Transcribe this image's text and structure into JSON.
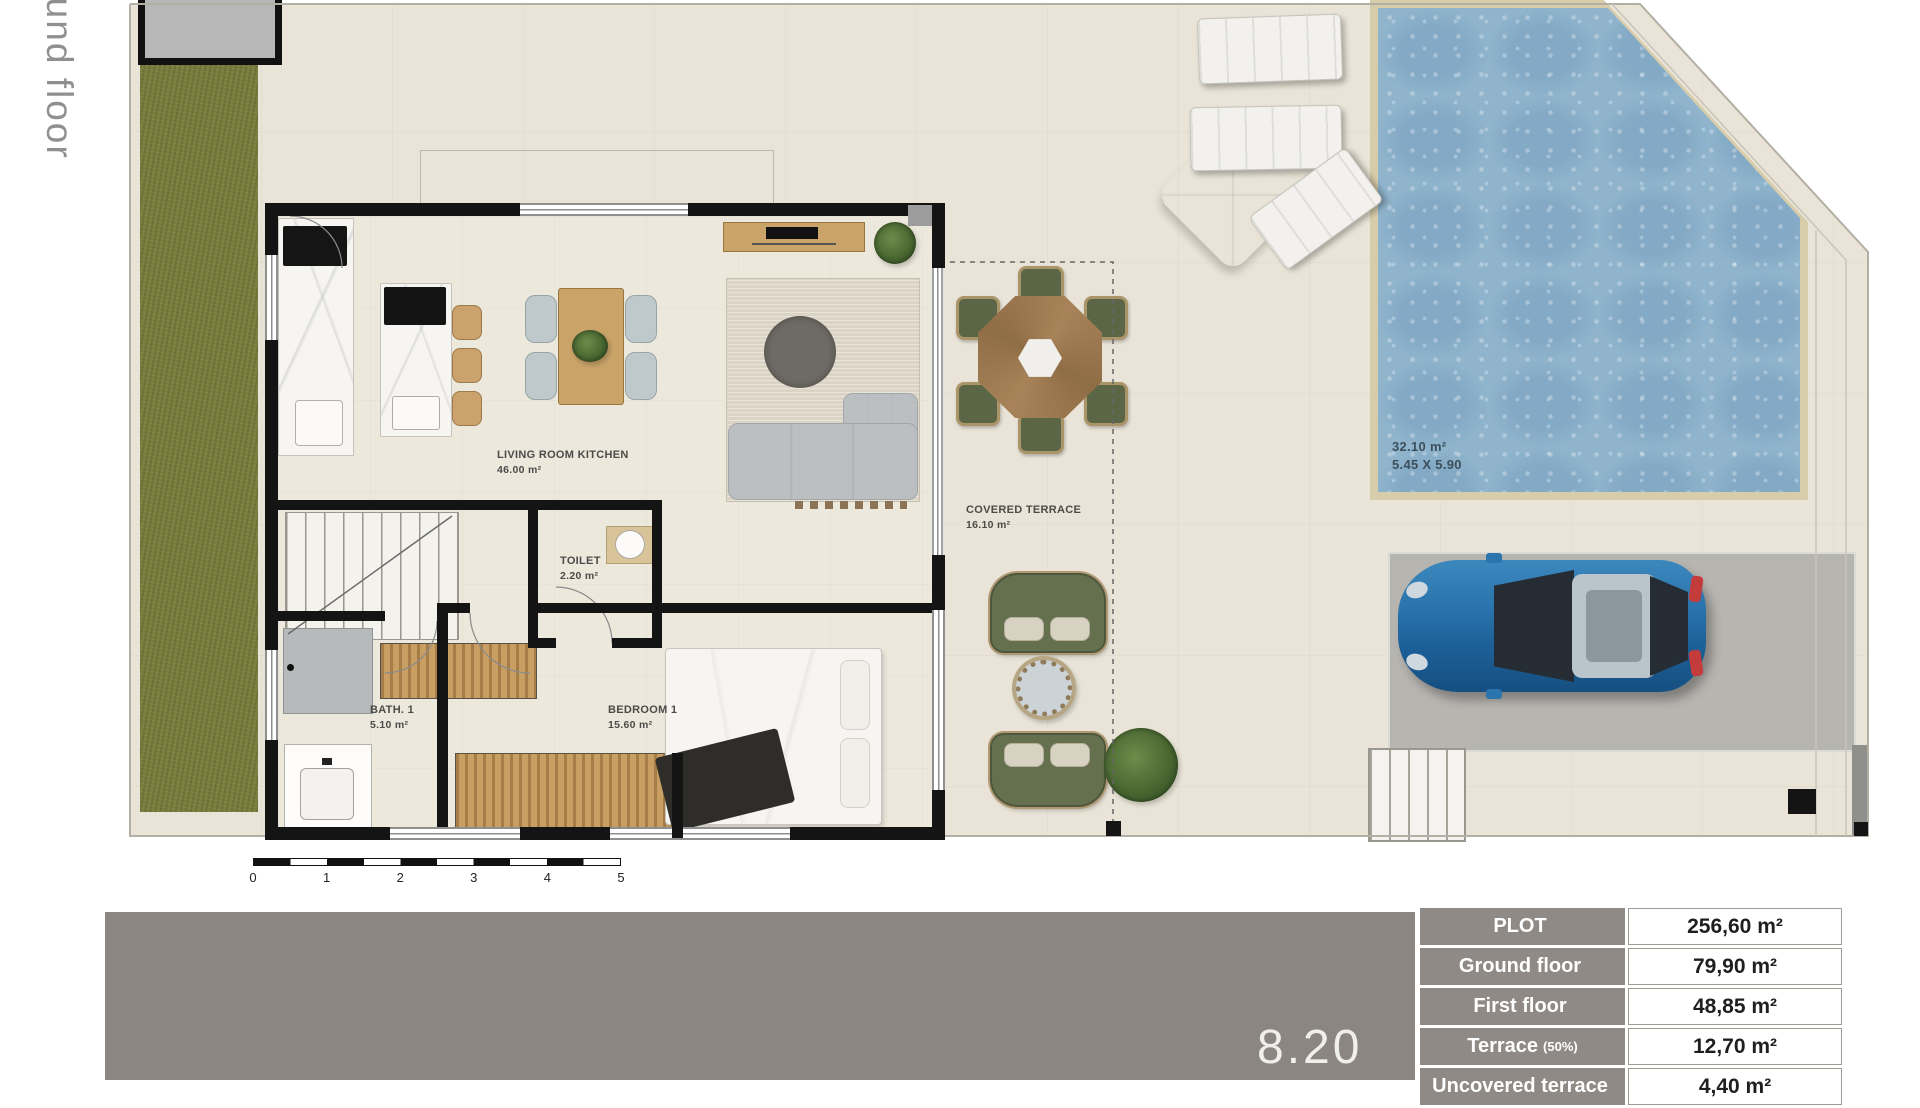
{
  "side_label": "Ground floor",
  "plan": {
    "rooms": [
      {
        "id": "living",
        "label": "LIVING ROOM KITCHEN",
        "area": "46.00 m²"
      },
      {
        "id": "toilet",
        "label": "TOILET",
        "area": "2.20 m²"
      },
      {
        "id": "bath",
        "label": "BATH. 1",
        "area": "5.10 m²"
      },
      {
        "id": "bedroom",
        "label": "BEDROOM 1",
        "area": "15.60 m²"
      },
      {
        "id": "terrace",
        "label": "COVERED TERRACE",
        "area": "16.10 m²"
      }
    ],
    "pool": {
      "area": "32.10 m²",
      "dimensions": "5.45 X 5.90"
    },
    "scale_bar": {
      "ticks": [
        "0",
        "1",
        "2",
        "3",
        "4",
        "5"
      ]
    }
  },
  "title_band": {
    "text": "8.20"
  },
  "areas_table": {
    "rows": [
      {
        "label": "PLOT",
        "value": "256,60 m²"
      },
      {
        "label": "Ground floor",
        "value": "79,90 m²"
      },
      {
        "label": "First floor",
        "value": "48,85 m²"
      },
      {
        "label": "Terrace",
        "note": "(50%)",
        "value": "12,70 m²"
      },
      {
        "label": "Uncovered terrace",
        "value": "4,40 m²"
      }
    ]
  },
  "colors": {
    "floor": "#e9e4d7",
    "grass": "#7b7d3d",
    "wall": "#141414",
    "pool_water": "#8fb4cc",
    "pool_coping": "#d8cdab",
    "parking": "#b7b5b0",
    "band_gray": "#8b8682",
    "table_label_bg": "#8f8a85",
    "accent_wood": "#c9a368",
    "terrace_green": "#65704f",
    "car_blue": "#2b74ad"
  }
}
